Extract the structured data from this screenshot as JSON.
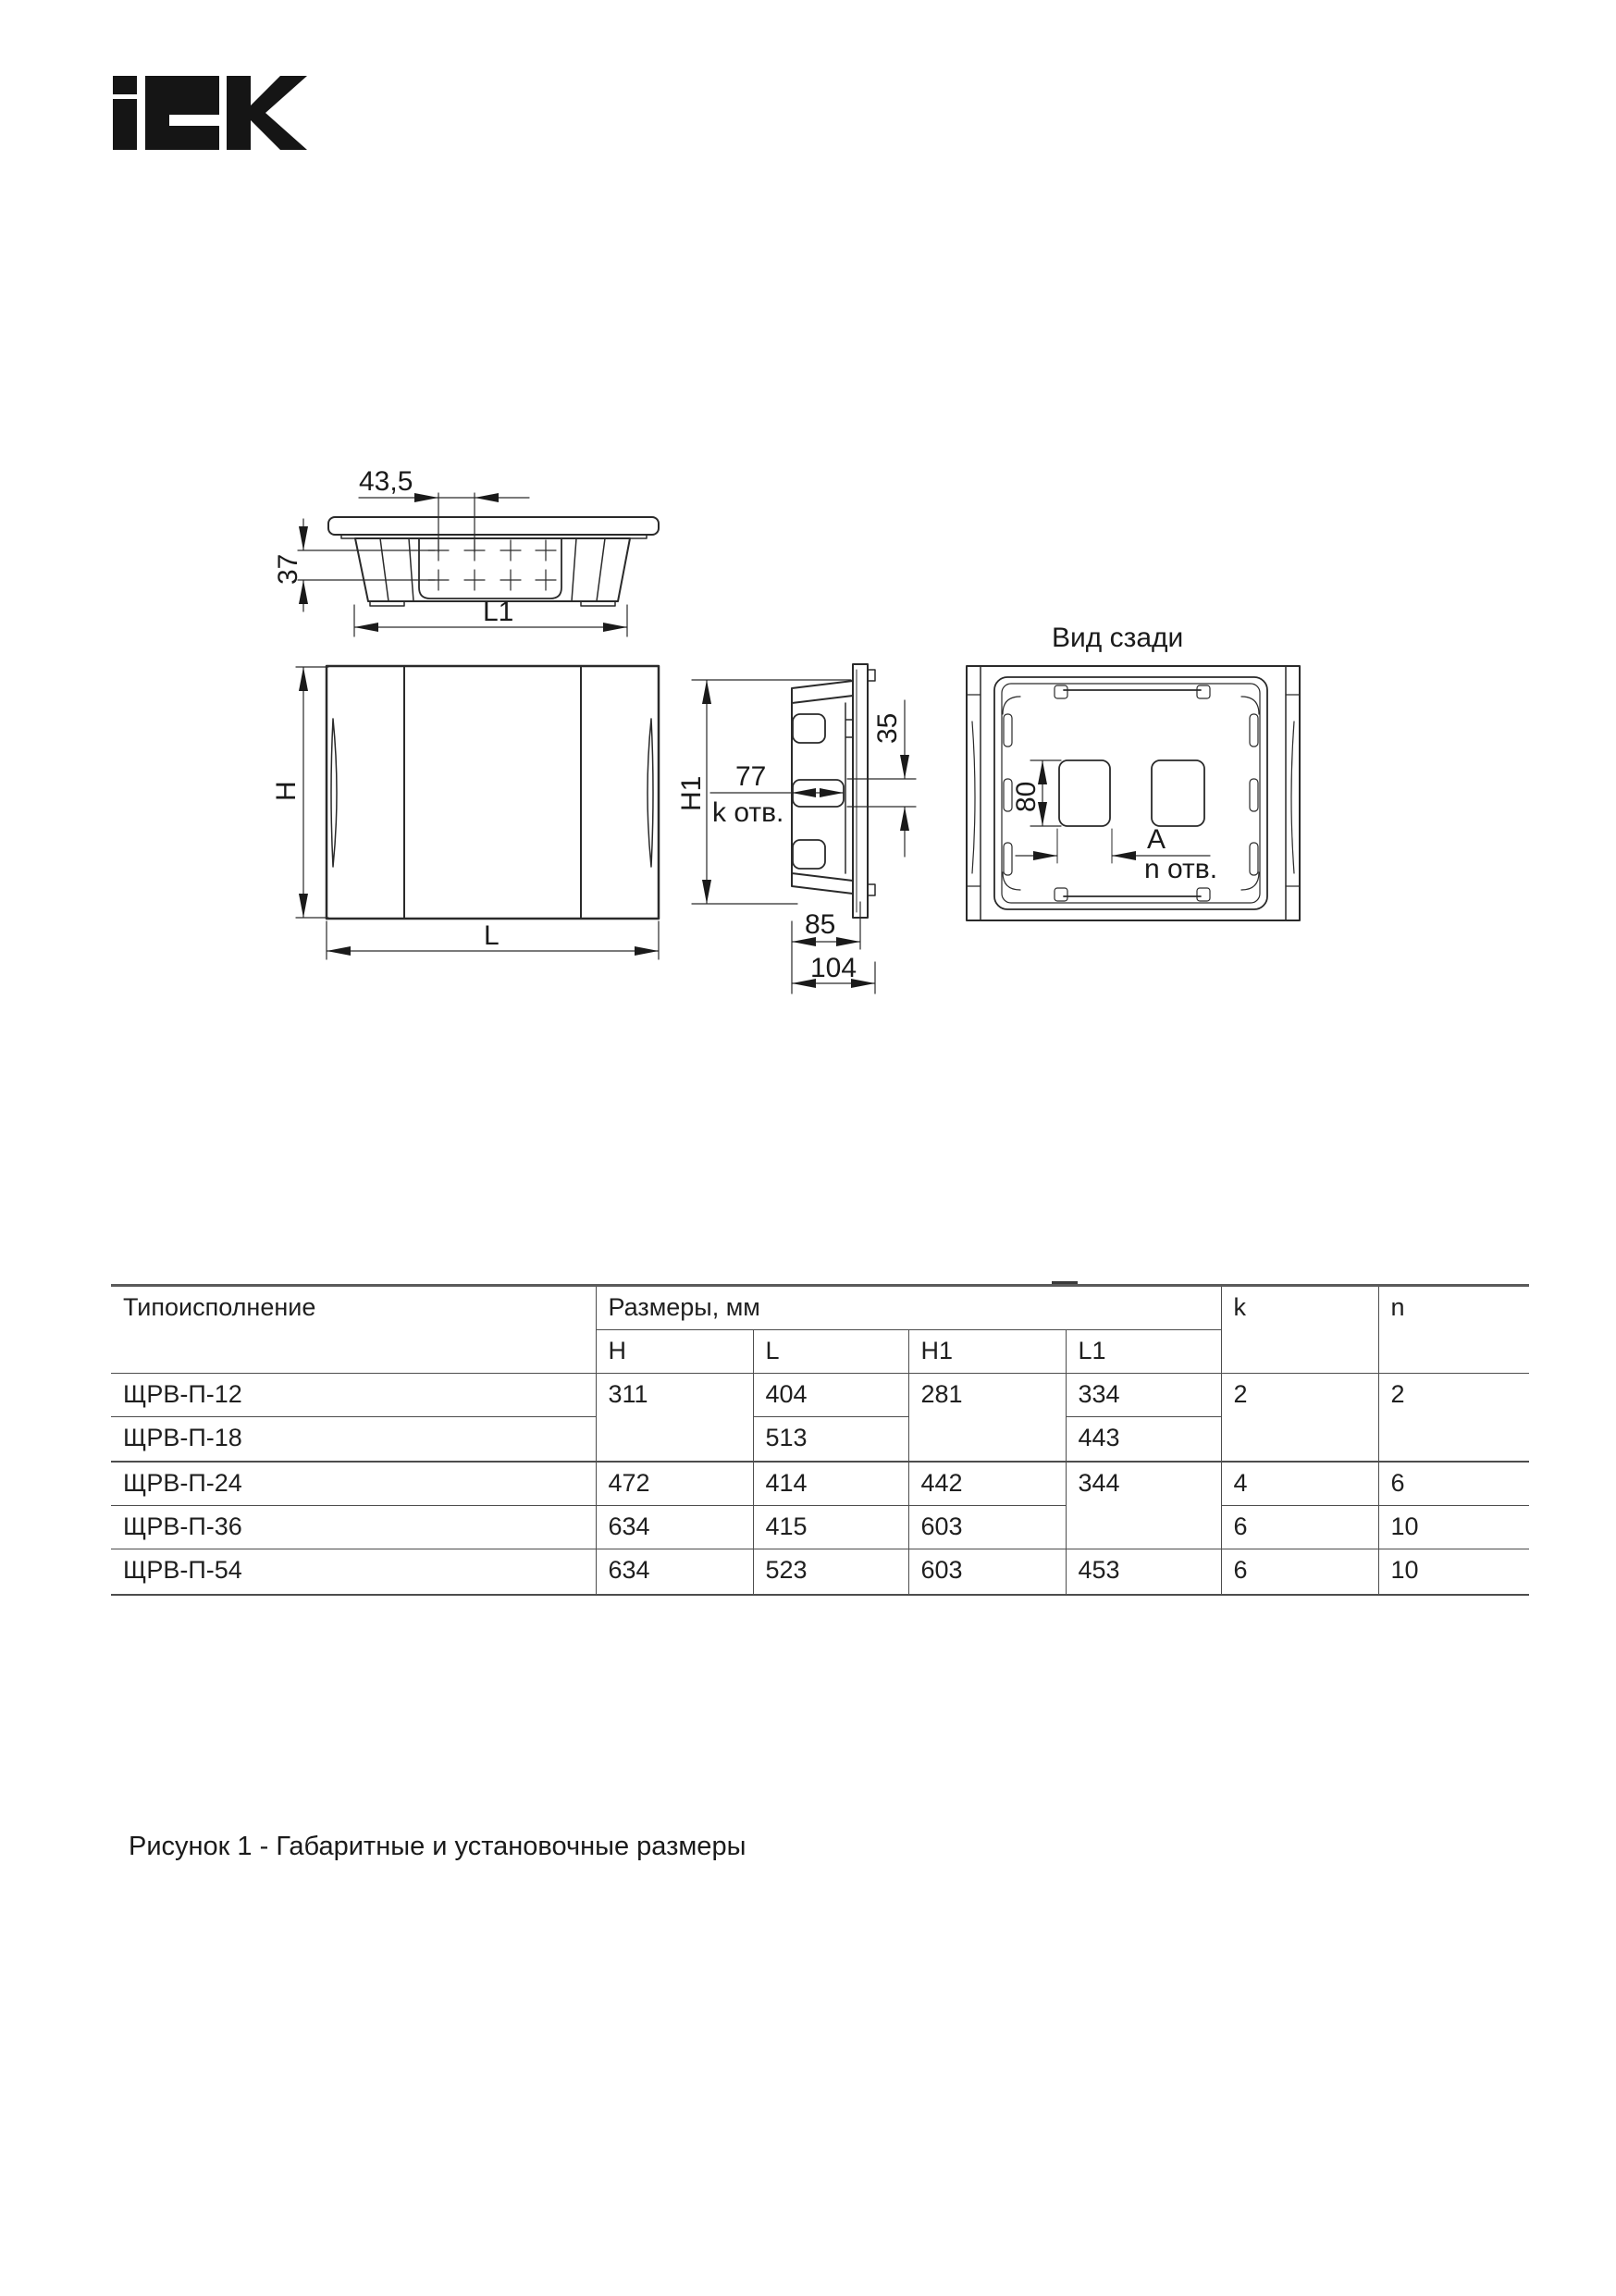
{
  "logo": {
    "alt": "IEK"
  },
  "drawing": {
    "rear_view_title": "Вид сзади",
    "dims": {
      "top_pitch_x": "43,5",
      "top_pitch_y": "37",
      "top_width": "L1",
      "front_height": "H",
      "front_width": "L",
      "side_height": "H1",
      "side_slot_width": "77",
      "side_slot_count": "k отв.",
      "side_slot_height": "35",
      "side_depth_box": "85",
      "side_depth_total": "104",
      "rear_knockout_height": "80",
      "rear_hole_pitch": "A",
      "rear_hole_count": "n отв."
    }
  },
  "table": {
    "headers": {
      "type": "Типоисполнение",
      "dims_group": "Размеры, мм",
      "sub": {
        "H": "H",
        "L": "L",
        "H1": "H1",
        "L1": "L1"
      },
      "k": "k",
      "n": "n"
    },
    "rows": [
      {
        "name": "ЩРВ-П-12",
        "H": "311",
        "L": "404",
        "H1": "281",
        "L1": "334",
        "k": "2",
        "n": "2"
      },
      {
        "name": "ЩРВ-П-18",
        "L": "513",
        "L1": "443"
      },
      {
        "name": "ЩРВ-П-24",
        "H": "472",
        "L": "414",
        "H1": "442",
        "L1": "344",
        "k": "4",
        "n": "6"
      },
      {
        "name": "ЩРВ-П-36",
        "H": "634",
        "L": "415",
        "H1": "603",
        "k": "6",
        "n": "10"
      },
      {
        "name": "ЩРВ-П-54",
        "H": "634",
        "L": "523",
        "H1": "603",
        "L1": "453",
        "k": "6",
        "n": "10"
      }
    ]
  },
  "caption": "Рисунок 1 - Габаритные и установочные размеры"
}
